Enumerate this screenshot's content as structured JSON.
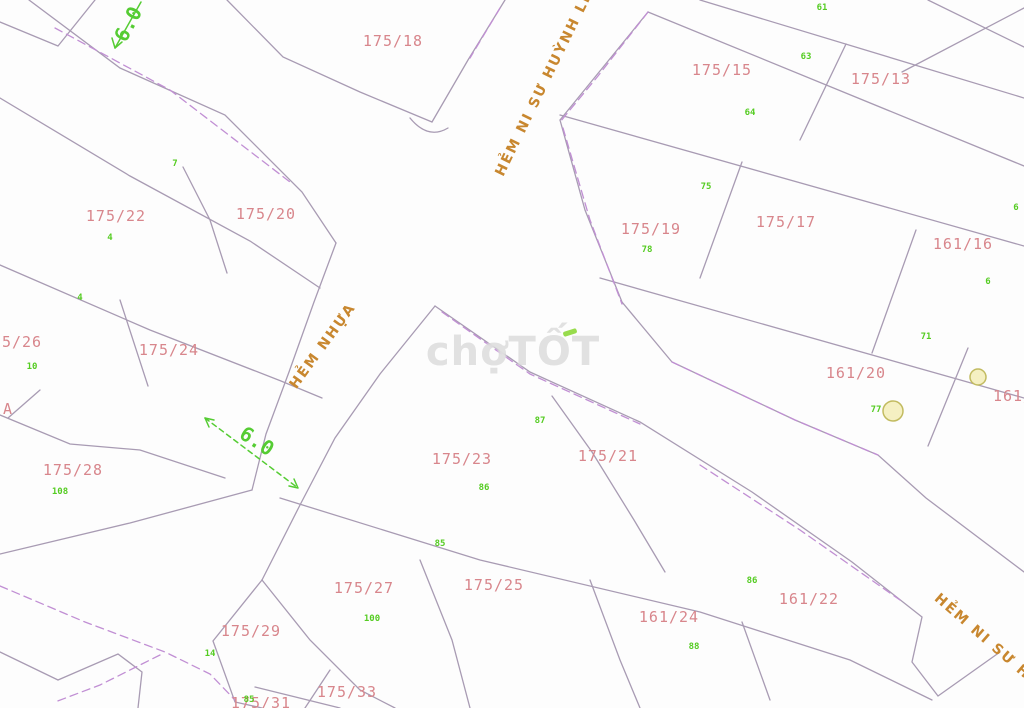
{
  "watermark": {
    "part1": "chợ",
    "part2": "TỐT"
  },
  "roads": [
    {
      "id": "hem-ni-su-huynh-lien-top",
      "label": "HẺM NI SƯ HUỲNH LIÊN",
      "x": 549,
      "y": 74,
      "rotate": -64
    },
    {
      "id": "hem-nhua",
      "label": "HẺM NHỰA",
      "x": 323,
      "y": 346,
      "rotate": -54
    },
    {
      "id": "hem-ni-su-huynh-lien-bottom",
      "label": "HẺM NI SƯ HUỲ",
      "x": 992,
      "y": 645,
      "rotate": 41
    }
  ],
  "dimensions": [
    {
      "label": "6.0",
      "x": 128,
      "y": 24,
      "rotate": -62
    },
    {
      "label": "6.0",
      "x": 257,
      "y": 441,
      "rotate": 33
    }
  ],
  "parcels": [
    {
      "label": "175/18",
      "x": 393,
      "y": 41
    },
    {
      "label": "175/15",
      "x": 722,
      "y": 70
    },
    {
      "label": "175/13",
      "x": 881,
      "y": 79
    },
    {
      "label": "175/22",
      "x": 116,
      "y": 216
    },
    {
      "label": "175/20",
      "x": 266,
      "y": 214
    },
    {
      "label": "175/19",
      "x": 651,
      "y": 229
    },
    {
      "label": "175/17",
      "x": 786,
      "y": 222
    },
    {
      "label": "161/16",
      "x": 963,
      "y": 244
    },
    {
      "label": "175/26",
      "x": 12,
      "y": 342
    },
    {
      "label": "175/24",
      "x": 169,
      "y": 350
    },
    {
      "label": "161/20",
      "x": 856,
      "y": 373
    },
    {
      "label": "161/",
      "x": 1013,
      "y": 396
    },
    {
      "label": "175/28",
      "x": 73,
      "y": 470
    },
    {
      "label": "175/23",
      "x": 462,
      "y": 459
    },
    {
      "label": "175/21",
      "x": 608,
      "y": 456
    },
    {
      "label": "175/27",
      "x": 364,
      "y": 588
    },
    {
      "label": "175/25",
      "x": 494,
      "y": 585
    },
    {
      "label": "161/24",
      "x": 669,
      "y": 617
    },
    {
      "label": "161/22",
      "x": 809,
      "y": 599
    },
    {
      "label": "175/29",
      "x": 251,
      "y": 631
    },
    {
      "label": "175/33",
      "x": 347,
      "y": 692
    },
    {
      "label": "175/31",
      "x": 261,
      "y": 703
    },
    {
      "label": "A",
      "x": 8,
      "y": 409
    }
  ],
  "lot_numbers": [
    {
      "label": "7",
      "x": 175,
      "y": 164
    },
    {
      "label": "4",
      "x": 110,
      "y": 238
    },
    {
      "label": "4",
      "x": 80,
      "y": 298
    },
    {
      "label": "10",
      "x": 32,
      "y": 367
    },
    {
      "label": "108",
      "x": 60,
      "y": 492
    },
    {
      "label": "61",
      "x": 822,
      "y": 8
    },
    {
      "label": "63",
      "x": 806,
      "y": 57
    },
    {
      "label": "64",
      "x": 750,
      "y": 113
    },
    {
      "label": "75",
      "x": 706,
      "y": 187
    },
    {
      "label": "78",
      "x": 647,
      "y": 250
    },
    {
      "label": "6",
      "x": 1016,
      "y": 208
    },
    {
      "label": "6",
      "x": 988,
      "y": 282
    },
    {
      "label": "71",
      "x": 926,
      "y": 337
    },
    {
      "label": "77",
      "x": 876,
      "y": 410
    },
    {
      "label": "87",
      "x": 540,
      "y": 421
    },
    {
      "label": "86",
      "x": 484,
      "y": 488
    },
    {
      "label": "85",
      "x": 440,
      "y": 544
    },
    {
      "label": "86",
      "x": 752,
      "y": 581
    },
    {
      "label": "88",
      "x": 694,
      "y": 647
    },
    {
      "label": "100",
      "x": 372,
      "y": 619
    },
    {
      "label": "14",
      "x": 210,
      "y": 654
    },
    {
      "label": "85",
      "x": 249,
      "y": 700
    }
  ],
  "trees": [
    {
      "x": 978,
      "y": 377,
      "r": 8
    },
    {
      "x": 893,
      "y": 411,
      "r": 10
    }
  ],
  "colors": {
    "boundary": "#a89bb3",
    "dashed_road": "#c18fd4",
    "parcel_text": "#d8868c",
    "lot_text": "#55cc22",
    "road_text": "#c8872f",
    "dimension": "#55cc33",
    "tree_fill": "#f5f0c2",
    "tree_stroke": "#c2bb60"
  }
}
